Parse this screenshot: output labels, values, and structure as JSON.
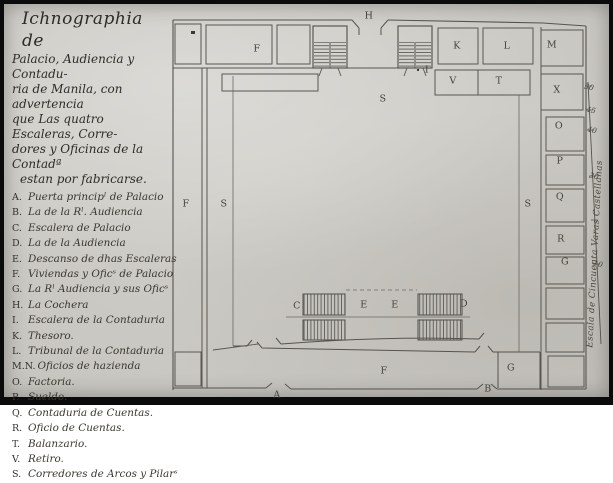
{
  "document": {
    "title_lines": [
      {
        "text": "Ichnographia de"
      },
      {
        "text": "Palacio, Audiencia y Contadu-"
      },
      {
        "text": "ria de Manila, con advertencia"
      },
      {
        "text": "que Las quatro Escaleras, Corre-"
      },
      {
        "text": "dores y Oficinas de la Contadª"
      },
      {
        "text": "estan por fabricarse."
      }
    ],
    "legend_entries": [
      {
        "key": "A.",
        "text": "Puerta principˡ de Palacio"
      },
      {
        "key": "B.",
        "text": "La de la Rˡ. Audiencia"
      },
      {
        "key": "C.",
        "text": "Escalera de Palacio"
      },
      {
        "key": "D.",
        "text": "La de la Audiencia"
      },
      {
        "key": "E.",
        "text": "Descanso de dhas Escaleras"
      },
      {
        "key": "F.",
        "text": "Viviendas y Oficˢ de Palacio"
      },
      {
        "key": "G.",
        "text": "La Rˡ Audiencia y sus Oficˢ"
      },
      {
        "key": "H.",
        "text": "La Cochera"
      },
      {
        "key": "I.",
        "text": "Escalera de la Contaduria"
      },
      {
        "key": "K.",
        "text": "Thesoro."
      },
      {
        "key": "L.",
        "text": "Tribunal de la Contaduria"
      },
      {
        "key": "M.N.",
        "text": "Oficios de hazienda"
      },
      {
        "key": "O.",
        "text": "Factoria."
      },
      {
        "key": "P.",
        "text": "Sueldo."
      },
      {
        "key": "Q.",
        "text": "Contaduria de Cuentas."
      },
      {
        "key": "R.",
        "text": "Oficio de Cuentas."
      },
      {
        "key": "T.",
        "text": "Balanzario."
      },
      {
        "key": "V.",
        "text": "Retiro."
      },
      {
        "key": "S.",
        "text": "Corredores de Arcos y Pilarˢ"
      }
    ],
    "plan_labels": [
      {
        "text": "H",
        "x": 369,
        "y": 16
      },
      {
        "text": "F",
        "x": 257,
        "y": 49
      },
      {
        "text": "K",
        "x": 457,
        "y": 46
      },
      {
        "text": "L",
        "x": 507,
        "y": 46
      },
      {
        "text": "M",
        "x": 552,
        "y": 45
      },
      {
        "text": "I",
        "x": 427,
        "y": 70
      },
      {
        "text": "V",
        "x": 453,
        "y": 81
      },
      {
        "text": "T",
        "x": 499,
        "y": 81
      },
      {
        "text": "X",
        "x": 557,
        "y": 90
      },
      {
        "text": "S",
        "x": 383,
        "y": 99
      },
      {
        "text": "O",
        "x": 559,
        "y": 126
      },
      {
        "text": "P",
        "x": 560,
        "y": 161
      },
      {
        "text": "Q",
        "x": 560,
        "y": 197
      },
      {
        "text": "R",
        "x": 561,
        "y": 239
      },
      {
        "text": "G",
        "x": 565,
        "y": 262
      },
      {
        "text": "F",
        "x": 186,
        "y": 204
      },
      {
        "text": "S",
        "x": 224,
        "y": 204
      },
      {
        "text": "S",
        "x": 528,
        "y": 204
      },
      {
        "text": "C",
        "x": 297,
        "y": 306
      },
      {
        "text": "E",
        "x": 364,
        "y": 305
      },
      {
        "text": "E",
        "x": 395,
        "y": 305
      },
      {
        "text": "D",
        "x": 464,
        "y": 304
      },
      {
        "text": "F",
        "x": 384,
        "y": 371
      },
      {
        "text": "G",
        "x": 511,
        "y": 368
      },
      {
        "text": "A",
        "x": 277,
        "y": 395
      },
      {
        "text": "B",
        "x": 488,
        "y": 389
      }
    ],
    "scale": {
      "title": "Escala de Cincuenta Varas Castellanas",
      "ticks": [
        {
          "label": "50",
          "x": 589,
          "y": 87
        },
        {
          "label": "45",
          "x": 591,
          "y": 110
        },
        {
          "label": "40",
          "x": 592,
          "y": 130
        },
        {
          "label": "30",
          "x": 594,
          "y": 176
        },
        {
          "label": "10",
          "x": 598,
          "y": 264
        }
      ]
    }
  }
}
